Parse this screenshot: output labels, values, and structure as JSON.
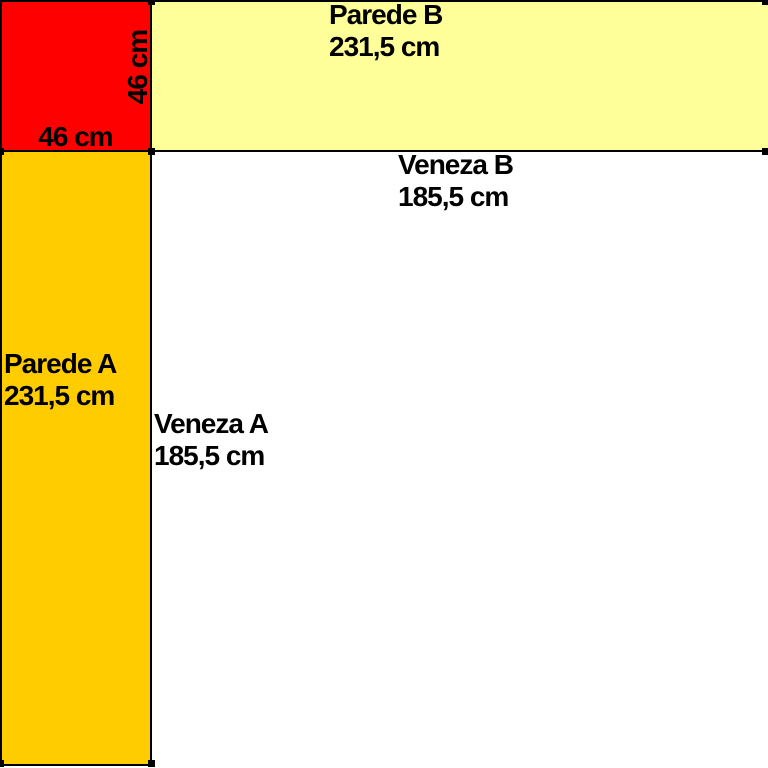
{
  "diagram": {
    "title": "wall-and-blind-measurement-diagram",
    "corner_square": {
      "width_label": "46 cm",
      "height_label": "46 cm",
      "color": "#ff0000"
    },
    "parede_b": {
      "name": "Parede B",
      "size": "231,5 cm",
      "color": "#ffff99"
    },
    "parede_a": {
      "name": "Parede A",
      "size": "231,5 cm",
      "color": "#ffcc00"
    },
    "veneza_b": {
      "name": "Veneza B",
      "size": "185,5 cm"
    },
    "veneza_a": {
      "name": "Veneza A",
      "size": "185,5 cm"
    },
    "line_color": "#000000",
    "background_color": "#ffffff"
  }
}
